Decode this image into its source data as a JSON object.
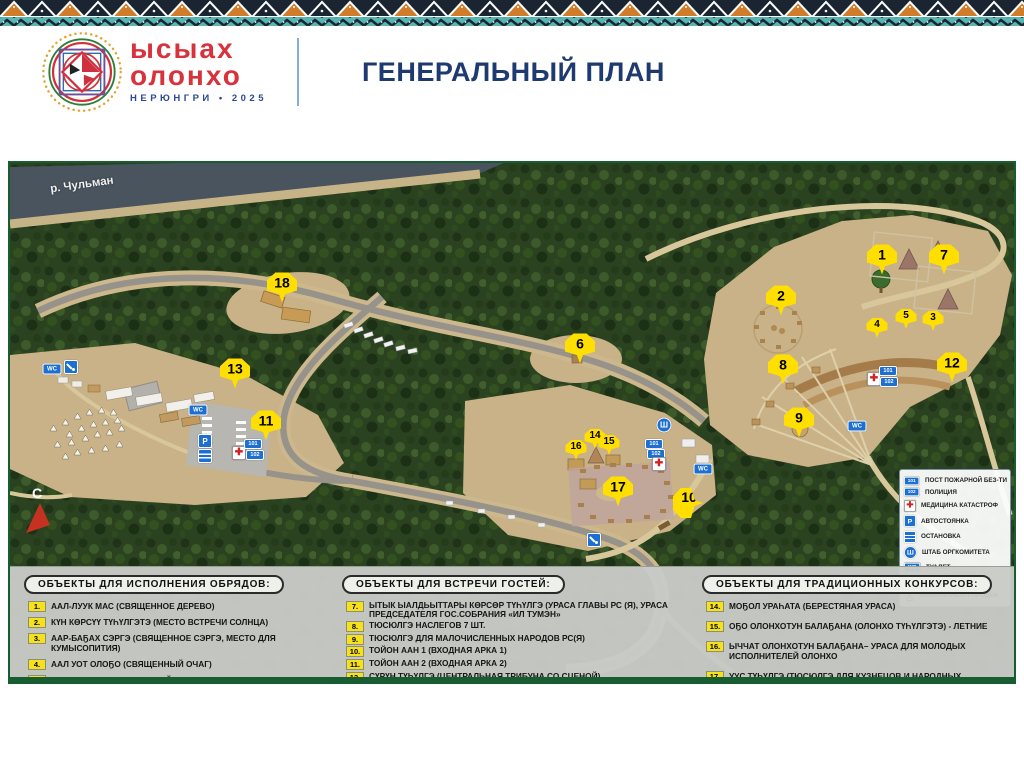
{
  "header": {
    "logo": {
      "line1": "ысыах",
      "line2": "олонхо",
      "subtitle": "НЕРЮНГРИ • 2025"
    },
    "title": "ГЕНЕРАЛЬНЫЙ ПЛАН"
  },
  "colors": {
    "accent_yellow": "#FFDF00",
    "title_navy": "#1F3A70",
    "logo_red": "#D8323C",
    "border_teal": "#57B5B2",
    "border_orange": "#CF7D2A",
    "map_frame_green": "#185C31",
    "sign_blue": "#1D6FD1",
    "river": "#49545E",
    "clearing_tan": "#C9B287"
  },
  "map": {
    "river_label": "р. Чульман",
    "compass_label": "С",
    "markers": [
      {
        "n": "1",
        "x": 872,
        "y": 98,
        "size": "lg"
      },
      {
        "n": "7",
        "x": 934,
        "y": 98,
        "size": "lg"
      },
      {
        "n": "2",
        "x": 771,
        "y": 139,
        "size": "lg"
      },
      {
        "n": "18",
        "x": 272,
        "y": 126,
        "size": "lg"
      },
      {
        "n": "13",
        "x": 225,
        "y": 212,
        "size": "lg"
      },
      {
        "n": "11",
        "x": 256,
        "y": 264,
        "size": "lg"
      },
      {
        "n": "6",
        "x": 570,
        "y": 187,
        "size": "lg"
      },
      {
        "n": "16",
        "x": 566,
        "y": 288,
        "size": "sm"
      },
      {
        "n": "14",
        "x": 585,
        "y": 277,
        "size": "sm"
      },
      {
        "n": "15",
        "x": 599,
        "y": 283,
        "size": "sm"
      },
      {
        "n": "17",
        "x": 608,
        "y": 330,
        "size": "lg"
      },
      {
        "n": "10",
        "x": 678,
        "y": 340,
        "size": "lg",
        "tail": "left"
      },
      {
        "n": "8",
        "x": 773,
        "y": 208,
        "size": "lg"
      },
      {
        "n": "9",
        "x": 789,
        "y": 261,
        "size": "lg"
      },
      {
        "n": "4",
        "x": 867,
        "y": 166,
        "size": "sm"
      },
      {
        "n": "5",
        "x": 896,
        "y": 157,
        "size": "sm"
      },
      {
        "n": "3",
        "x": 923,
        "y": 159,
        "size": "sm"
      },
      {
        "n": "12",
        "x": 942,
        "y": 206,
        "size": "lg"
      }
    ],
    "sign_glyphs": {
      "wc": "WC",
      "fire": "101",
      "police": "102",
      "parking": "P",
      "hq": "Ш",
      "cross": "✚"
    },
    "signs": [
      {
        "type": "wc",
        "x": 42,
        "y": 206
      },
      {
        "type": "shower",
        "x": 61,
        "y": 204
      },
      {
        "type": "wc",
        "x": 188,
        "y": 247
      },
      {
        "type": "parking",
        "x": 195,
        "y": 278
      },
      {
        "type": "bus",
        "x": 195,
        "y": 293
      },
      {
        "type": "cross",
        "x": 229,
        "y": 290
      },
      {
        "type": "fire",
        "x": 243,
        "y": 281
      },
      {
        "type": "police",
        "x": 245,
        "y": 292
      },
      {
        "type": "hq",
        "x": 654,
        "y": 262
      },
      {
        "type": "fire",
        "x": 644,
        "y": 281
      },
      {
        "type": "police",
        "x": 646,
        "y": 291
      },
      {
        "type": "cross",
        "x": 649,
        "y": 301
      },
      {
        "type": "wc",
        "x": 693,
        "y": 306
      },
      {
        "type": "shower",
        "x": 584,
        "y": 363
      },
      {
        "type": "wc",
        "x": 847,
        "y": 263
      },
      {
        "type": "cross",
        "x": 864,
        "y": 216
      },
      {
        "type": "fire",
        "x": 878,
        "y": 208
      },
      {
        "type": "police",
        "x": 879,
        "y": 219
      }
    ],
    "map_legend_items": [
      {
        "icon": "fire",
        "label": "ПОСТ ПОЖАРНОЙ БЕЗ-ТИ"
      },
      {
        "icon": "police",
        "label": "ПОЛИЦИЯ"
      },
      {
        "icon": "cross",
        "label": "МЕДИЦИНА КАТАСТРОФ"
      },
      {
        "icon": "parking",
        "label": "АВТОСТОЯНКА"
      },
      {
        "icon": "bus",
        "label": "ОСТАНОВКА"
      },
      {
        "icon": "hq",
        "label": "ШТАБ ОРГКОМИТЕТА"
      },
      {
        "icon": "wc",
        "label": "ТУАЛЕТ"
      },
      {
        "icon": "shower",
        "label": "ДУШ"
      },
      {
        "icon": "tent",
        "label": "ПАЛАТОЧНЫЙ ГОРОДОК"
      }
    ]
  },
  "legend_boxes": [
    {
      "title": "ОБЪЕКТЫ ДЛЯ ИСПОЛНЕНИЯ ОБРЯДОВ:",
      "items": [
        {
          "num": "1.",
          "text": "ААЛ-ЛУУК МАС (СВЯЩЕННОЕ ДЕРЕВО)"
        },
        {
          "num": "2.",
          "text": "КҮН КӨРСҮҮ ТҮҺҮЛГЭТЭ (МЕСТО ВСТРЕЧИ СОЛНЦА)"
        },
        {
          "num": "3.",
          "text": "ААР-БАҔАХ СЭРГЭ (СВЯЩЕННОЕ СЭРГЭ, МЕСТО ДЛЯ КУМЫСОПИТИЯ)"
        },
        {
          "num": "4.",
          "text": "ААЛ УОТ ОЛОҔО (СВЯЩЕННЫЙ ОЧАГ)"
        },
        {
          "num": "5.",
          "text": "ЫТЫК ДУОҔА (СВЯЩЕННЫЙ СИМВОЛ ЫСЫАХА ОЛОНХО)"
        },
        {
          "num": "6.",
          "text": "ТОЙОН СЭРГЭ («АЛТАН СЭРГЭ» ОҺУОХАЙ ТҮҺҮЛГЭТЭ)"
        }
      ]
    },
    {
      "title": "ОБЪЕКТЫ ДЛЯ ВСТРЕЧИ ГОСТЕЙ:",
      "items": [
        {
          "num": "7.",
          "text": "ЫТЫК ЫАЛДЬЫТТАРЫ КӨРСӨР ТҮҺҮЛГЭ (УРАСА ГЛАВЫ РС (Я), УРАСА ПРЕДСЕДАТЕЛЯ ГОС.СОБРАНИЯ «ИЛ ТУМЭН»"
        },
        {
          "num": "8.",
          "text": "ТЮСЮЛГЭ НАСЛЕГОВ 7 ШТ."
        },
        {
          "num": "9.",
          "text": "ТЮСЮЛГЭ ДЛЯ МАЛОЧИСЛЕННЫХ НАРОДОВ РС(Я)"
        },
        {
          "num": "10.",
          "text": "ТОЙОН ААН 1 (ВХОДНАЯ АРКА 1)"
        },
        {
          "num": "11.",
          "text": "ТОЙОН ААН 2 (ВХОДНАЯ АРКА 2)"
        },
        {
          "num": "12.",
          "text": "СҮРҮН ТҮҺҮЛГЭ (ЦЕНТРАЛЬНАЯ ТРИБУНА СО СЦЕНОЙ)"
        },
        {
          "num": "13.",
          "text": "ТОРГОВЫЕ ПАЛАТКИ, ФУДКОРТ"
        }
      ]
    },
    {
      "title": "ОБЪЕКТЫ ДЛЯ ТРАДИЦИОННЫХ КОНКУРСОВ:",
      "items": [
        {
          "num": "14.",
          "text": "МОҔОЛ УРАҺАТА (БЕРЕСТЯНАЯ УРАСА)"
        },
        {
          "num": "15.",
          "text": "ОҔО ОЛОНХОТУН БАЛАҔАНА (ОЛОНХО ТҮҺҮЛГЭТЭ) - ЛЕТНИЕ"
        },
        {
          "num": "16.",
          "text": "ЫЧЧАТ ОЛОНХОТУН БАЛАҔАНА– УРАСА ДЛЯ МОЛОДЫХ ИСПОЛНИТЕЛЕЙ ОЛОНХО"
        },
        {
          "num": "17.",
          "text": "УУС ТҮҺҮЛГЭ (ТЮСЮЛГЭ ДЛЯ КУЗНЕЦОВ И НАРОДНЫХ МАСТЕРОВ)"
        },
        {
          "num": "18.",
          "text": "ХОМУС ТҮҺҮЛГЭТЭ (ТЮСЮЛГЭ ХОМУСИСТОВ)"
        }
      ]
    }
  ]
}
